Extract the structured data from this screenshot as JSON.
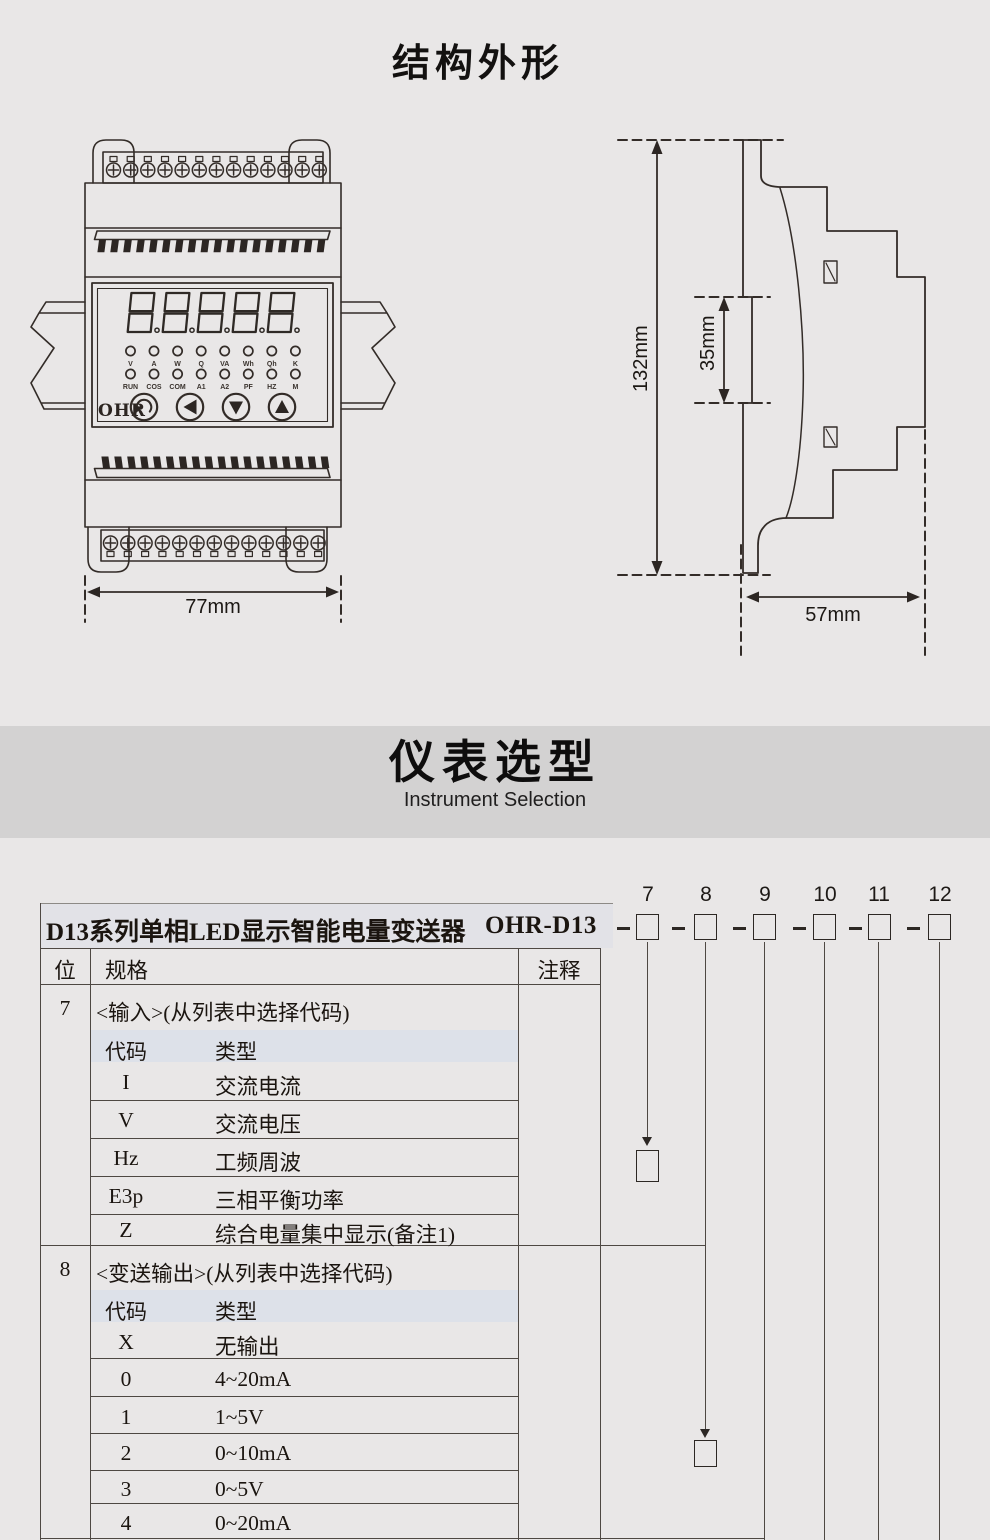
{
  "structure": {
    "title": "结构外形"
  },
  "front_view": {
    "logo": "OHR",
    "width_label": "77mm",
    "led_row1": [
      "V",
      "A",
      "W",
      "Q",
      "VA",
      "Wh",
      "Qh",
      "K"
    ],
    "led_row2": [
      "RUN",
      "COS",
      "COM",
      "A1",
      "A2",
      "PF",
      "HZ",
      "M"
    ],
    "buttons": [
      "cycle",
      "left",
      "down",
      "up"
    ],
    "display": "8.8.8.8.8."
  },
  "side_view": {
    "height_label": "132mm",
    "rail_label": "35mm",
    "depth_label": "57mm"
  },
  "selection": {
    "title": "仪表选型",
    "subtitle": "Instrument Selection"
  },
  "ordering": {
    "product_title": "D13系列单相LED显示智能电量变送器",
    "model_prefix": "OHR-D13",
    "positions": [
      "7",
      "8",
      "9",
      "10",
      "11",
      "12"
    ],
    "table": {
      "headers": {
        "pos": "位",
        "spec": "规格",
        "note": "注释"
      },
      "sections": [
        {
          "pos": "7",
          "title": "<输入>(从列表中选择代码)",
          "sub": {
            "code": "代码",
            "type": "类型"
          },
          "rows": [
            {
              "code": "I",
              "type": "交流电流"
            },
            {
              "code": "V",
              "type": "交流电压"
            },
            {
              "code": "Hz",
              "type": "工频周波"
            },
            {
              "code": "E3p",
              "type": "三相平衡功率"
            },
            {
              "code": "Z",
              "type": "综合电量集中显示(备注1)"
            }
          ]
        },
        {
          "pos": "8",
          "title": "<变送输出>(从列表中选择代码)",
          "sub": {
            "code": "代码",
            "type": "类型"
          },
          "rows": [
            {
              "code": "X",
              "type": "无输出"
            },
            {
              "code": "0",
              "type": "4~20mA"
            },
            {
              "code": "1",
              "type": "1~5V"
            },
            {
              "code": "2",
              "type": "0~10mA"
            },
            {
              "code": "3",
              "type": "0~5V"
            },
            {
              "code": "4",
              "type": "0~20mA"
            }
          ]
        }
      ]
    }
  },
  "colors": {
    "page_bg": "#e9e7e7",
    "band_bg": "#d3d2d2",
    "line": "#332c28",
    "subheader_bg": "#dde1e9"
  }
}
